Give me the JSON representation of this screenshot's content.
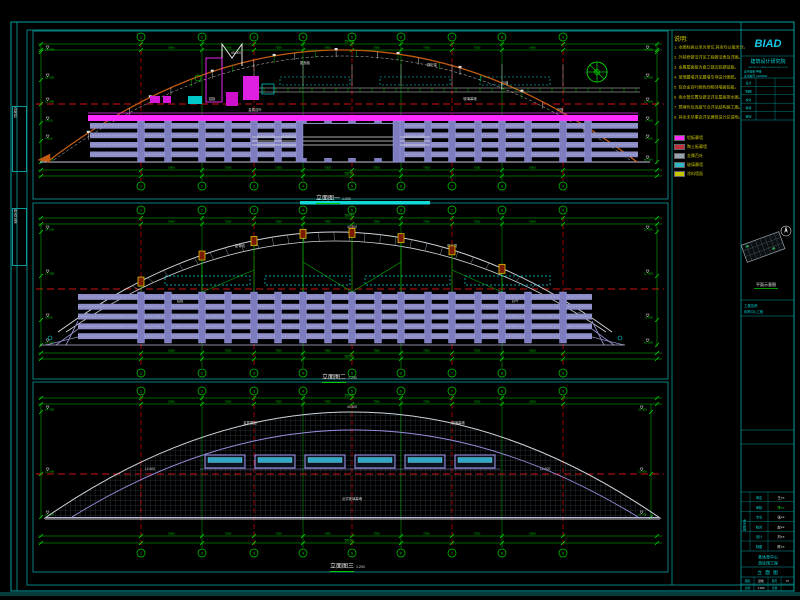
{
  "canvas": {
    "w": 800,
    "h": 600,
    "bg": "#000000"
  },
  "colors": {
    "frame": "#00a2a2",
    "viewport": "#0b8f8f",
    "grid_green": "#00b400",
    "grid_red": "#c40000",
    "dim": "#00c800",
    "bubble": "#00d200",
    "arc_orange": "#c05a10",
    "magenta": "#ff2bff",
    "louver": "#8d8dc8",
    "column": "#7d7dc0",
    "roof_gray": "#cfd6dc",
    "mesh": "#5c6a74",
    "cyan": "#00d8d8",
    "yellow": "#c9c400",
    "white": "#e8e8e8",
    "red_dash": "#cf1010",
    "window_frame": "#9a8fe0",
    "window_glass": "#2fa8c8",
    "node_fill": "#7a1a00",
    "node_stroke": "#e0c400",
    "green_bright": "#18e018"
  },
  "grid": {
    "xs": [
      141,
      202,
      254,
      303,
      352,
      401,
      452,
      502,
      563
    ],
    "labels": [
      "1",
      "2",
      "3",
      "4",
      "5",
      "6",
      "7",
      "8",
      "9"
    ],
    "red_idx": [
      0,
      2,
      4,
      6,
      8
    ]
  },
  "dims": {
    "spans": [
      "5000",
      "7500",
      "7500",
      "7500",
      "7500",
      "7500",
      "7500",
      "5000"
    ],
    "total": "55000"
  },
  "views": [
    {
      "id": "v1",
      "label": "立面图一",
      "scale": "1:200",
      "levels": [
        "24.000",
        "18.000",
        "12.600",
        "9.000",
        "4.500",
        "±0.000"
      ],
      "ann": [
        {
          "x": 236,
          "y": 54,
          "t": "45.000"
        },
        {
          "x": 305,
          "y": 64,
          "t": "屋面板"
        },
        {
          "x": 432,
          "y": 66,
          "t": "钢桁架"
        },
        {
          "x": 505,
          "y": 84,
          "t": "马道"
        },
        {
          "x": 212,
          "y": 100,
          "t": "铝板"
        },
        {
          "x": 470,
          "y": 100,
          "t": "玻璃幕墙"
        },
        {
          "x": 255,
          "y": 111,
          "t": "金属百叶"
        },
        {
          "x": 560,
          "y": 111,
          "t": "雨篷"
        }
      ]
    },
    {
      "id": "v2",
      "label": "立面图二",
      "scale": "1:200",
      "levels": [
        "24.000",
        "12.600",
        "4.500",
        "±0.000"
      ],
      "ann": [
        {
          "x": 352,
          "y": 228,
          "t": "44.500"
        },
        {
          "x": 240,
          "y": 247,
          "t": "屋脊线"
        },
        {
          "x": 452,
          "y": 247,
          "t": "采光顶"
        },
        {
          "x": 180,
          "y": 302,
          "t": "铝板"
        },
        {
          "x": 515,
          "y": 302,
          "t": "百叶"
        }
      ]
    },
    {
      "id": "v3",
      "label": "立面图三",
      "scale": "1:200",
      "levels": [
        "24.000",
        "12.600",
        "±0.000"
      ],
      "ann": [
        {
          "x": 352,
          "y": 408,
          "t": "44.500"
        },
        {
          "x": 250,
          "y": 424,
          "t": "金属屋面"
        },
        {
          "x": 458,
          "y": 424,
          "t": "玻璃幕墙"
        },
        {
          "x": 150,
          "y": 470,
          "t": "12.600"
        },
        {
          "x": 545,
          "y": 470,
          "t": "12.600"
        },
        {
          "x": 352,
          "y": 500,
          "t": "点式玻璃幕墙"
        }
      ]
    }
  ],
  "legend": {
    "title": "说明:",
    "notes": [
      "1. 本图标高以米为单位,其余均以毫米计。",
      "2. 外装修做法详见工程做法表及详图。",
      "3. 金属屋面板为直立锁边铝镁锰板。",
      "4. 玻璃幕墙详见幕墙专项设计图纸。",
      "5. 铝合金百叶颜色同相邻墙面铝板。",
      "6. 雨水管位置及做法详见屋面排水图。",
      "7. 预埋件及连接节点详见结构施工图。",
      "8. 其余未尽事宜详见建筑设计总说明。"
    ],
    "items": [
      {
        "color": "#ff2bff",
        "label": "铝板幕墙"
      },
      {
        "color": "#c03040",
        "label": "陶土板幕墙"
      },
      {
        "color": "#9aa4ae",
        "label": "金属百叶"
      },
      {
        "color": "#30b8c8",
        "label": "玻璃幕墙"
      },
      {
        "color": "#c9c400",
        "label": "涂料墙面"
      }
    ]
  },
  "titleblock": {
    "logo": "BIAD",
    "company": "建筑设计研究院",
    "company_en": "ARCHITECTURAL DESIGN INSTITUTE",
    "cert": [
      [
        "证书等级",
        "甲级"
      ],
      [
        "证书编号",
        "A100000"
      ]
    ],
    "table_rows": [
      [
        "设计",
        ""
      ],
      [
        "制图",
        ""
      ],
      [
        "校对",
        ""
      ],
      [
        "审核",
        ""
      ],
      [
        "审定",
        ""
      ]
    ],
    "section1": "工程名称",
    "section1_val": "体育中心工程",
    "keyplan_caption": "平面示意图",
    "discipline": "建筑专业",
    "sig_rows": [
      [
        "审定",
        "王××"
      ],
      [
        "审核",
        "李××"
      ],
      [
        "专业",
        "张××"
      ],
      [
        "校对",
        "赵××"
      ],
      [
        "设计",
        "刘××"
      ],
      [
        "制图",
        "陈××"
      ]
    ],
    "project_line1": "某体育中心",
    "project_line2": "游泳馆工程",
    "sheet_title": "立 面 图",
    "info": [
      [
        "图别",
        "建施"
      ],
      [
        "图号",
        "07"
      ],
      [
        "比例",
        "1:200"
      ],
      [
        "日期",
        ""
      ]
    ]
  },
  "binding": {
    "box1": "会签栏",
    "box2": "修改记录"
  }
}
